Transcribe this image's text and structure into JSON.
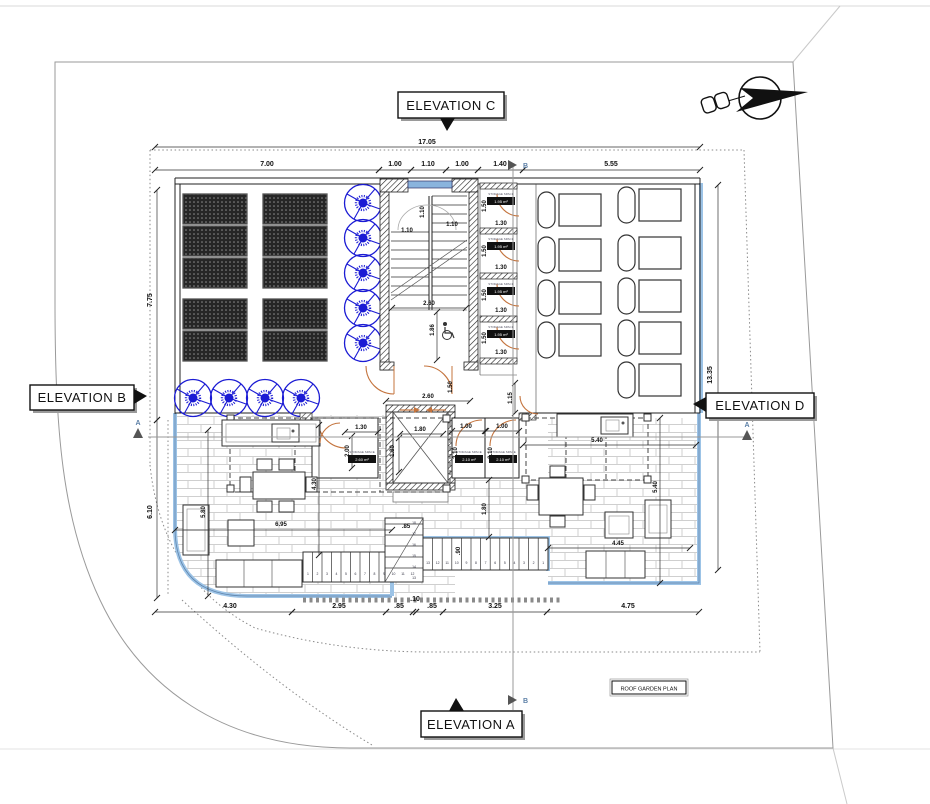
{
  "page": {
    "plan_title": "ROOF GARDEN PLAN"
  },
  "elevations": {
    "a": "ELEVATION A",
    "b": "ELEVATION B",
    "c": "ELEVATION C",
    "d": "ELEVATION D"
  },
  "sections": {
    "a": "A",
    "b": "B"
  },
  "storage": {
    "label": "STORAGE SPACE",
    "area_small": "1.95 m²",
    "area_mid_left": "2.60 m²",
    "area_mid_right": "2.10 m²"
  },
  "stairs": {
    "run_a": [
      "1",
      "2",
      "3",
      "4",
      "5",
      "6",
      "7",
      "8",
      "9",
      "10",
      "11",
      "12"
    ],
    "run_b": [
      "13",
      "12",
      "11",
      "10",
      "9",
      "8",
      "7",
      "6",
      "5",
      "4",
      "3",
      "2",
      "1"
    ],
    "run_c": [
      "18",
      "17",
      "16",
      "15",
      "14",
      "13"
    ]
  },
  "colors": {
    "deck_edge": "#9cc3e6",
    "tree": "#1b1bd4",
    "door": "#c4743e",
    "wall": "#222222",
    "brick_joint": "#cfcfcf",
    "section_line": "#999999",
    "boundary": "#9a9a9a"
  },
  "dims": [
    {
      "t": "17.05",
      "x": 427,
      "y": 144,
      "s": 7,
      "l": [
        155,
        147,
        700,
        147
      ]
    },
    {
      "t": "7.00",
      "x": 267,
      "y": 166,
      "s": 7,
      "l": [
        155,
        170,
        379,
        170
      ]
    },
    {
      "t": "1.00",
      "x": 395,
      "y": 166,
      "s": 7,
      "l": [
        379,
        170,
        411,
        170
      ]
    },
    {
      "t": "1.10",
      "x": 428,
      "y": 166,
      "s": 7,
      "l": [
        411,
        170,
        446,
        170
      ]
    },
    {
      "t": "1.00",
      "x": 462,
      "y": 166,
      "s": 7,
      "l": [
        446,
        170,
        478,
        170
      ]
    },
    {
      "t": "1.40",
      "x": 500,
      "y": 166,
      "s": 7,
      "l": [
        478,
        170,
        523,
        170
      ]
    },
    {
      "t": "5.55",
      "x": 611,
      "y": 166,
      "s": 7,
      "l": [
        523,
        170,
        700,
        170
      ]
    },
    {
      "t": "7.75",
      "x": 152,
      "y": 300,
      "r": -90,
      "s": 7,
      "l": [
        157,
        190,
        157,
        420
      ]
    },
    {
      "t": "6.10",
      "x": 152,
      "y": 512,
      "r": -90,
      "s": 7,
      "l": [
        157,
        420,
        157,
        598
      ]
    },
    {
      "t": "13.35",
      "x": 712,
      "y": 375,
      "r": -90,
      "s": 7,
      "l": [
        718,
        185,
        718,
        570
      ]
    },
    {
      "t": "4.30",
      "x": 230,
      "y": 608,
      "s": 7,
      "l": [
        155,
        612,
        292,
        612
      ]
    },
    {
      "t": "2.95",
      "x": 339,
      "y": 608,
      "s": 7,
      "l": [
        292,
        612,
        386,
        612
      ]
    },
    {
      "t": ".85",
      "x": 399,
      "y": 608,
      "s": 7,
      "l": [
        386,
        612,
        413,
        612
      ]
    },
    {
      "t": ".10",
      "x": 415,
      "y": 601,
      "s": 7,
      "l": [
        413,
        612,
        416,
        612
      ]
    },
    {
      "t": ".85",
      "x": 432,
      "y": 608,
      "s": 7,
      "l": [
        416,
        612,
        443,
        612
      ]
    },
    {
      "t": "3.25",
      "x": 495,
      "y": 608,
      "s": 7,
      "l": [
        443,
        612,
        547,
        612
      ]
    },
    {
      "t": "4.75",
      "x": 628,
      "y": 608,
      "s": 7,
      "l": [
        547,
        612,
        699,
        612
      ]
    },
    {
      "t": "1.10",
      "x": 424,
      "y": 212,
      "r": -90,
      "s": 6
    },
    {
      "t": "1.10",
      "x": 407,
      "y": 232,
      "s": 6
    },
    {
      "t": "1.10",
      "x": 452,
      "y": 226,
      "s": 6
    },
    {
      "t": "2.60",
      "x": 429,
      "y": 305,
      "s": 6,
      "l": [
        392,
        308,
        466,
        308
      ]
    },
    {
      "t": "1.86",
      "x": 434,
      "y": 330,
      "r": -90,
      "s": 6,
      "l": [
        437,
        312,
        437,
        360
      ]
    },
    {
      "t": "2.60",
      "x": 428,
      "y": 398,
      "s": 6,
      "l": [
        386,
        401,
        470,
        401
      ]
    },
    {
      "t": "1.50",
      "x": 452,
      "y": 387,
      "r": -90,
      "s": 6
    },
    {
      "t": "1.15",
      "x": 512,
      "y": 398,
      "r": -90,
      "s": 6,
      "l": [
        515,
        383,
        515,
        413
      ]
    },
    {
      "t": "1.50",
      "x": 486,
      "y": 206,
      "r": -90,
      "s": 6
    },
    {
      "t": "1.30",
      "x": 501,
      "y": 225,
      "s": 6
    },
    {
      "t": "1.50",
      "x": 486,
      "y": 251,
      "r": -90,
      "s": 6
    },
    {
      "t": "1.30",
      "x": 501,
      "y": 269,
      "s": 6
    },
    {
      "t": "1.50",
      "x": 486,
      "y": 295,
      "r": -90,
      "s": 6
    },
    {
      "t": "1.30",
      "x": 501,
      "y": 312,
      "s": 6
    },
    {
      "t": "1.50",
      "x": 486,
      "y": 338,
      "r": -90,
      "s": 6
    },
    {
      "t": "1.30",
      "x": 501,
      "y": 354,
      "s": 6
    },
    {
      "t": "1.30",
      "x": 361,
      "y": 429,
      "s": 6,
      "l": [
        345,
        432,
        378,
        432
      ]
    },
    {
      "t": "2.00",
      "x": 349,
      "y": 451,
      "r": -90,
      "s": 6,
      "l": [
        352,
        436,
        352,
        468
      ]
    },
    {
      "t": "1.80",
      "x": 420,
      "y": 431,
      "s": 6,
      "l": [
        400,
        434,
        443,
        434
      ]
    },
    {
      "t": "1.80",
      "x": 394,
      "y": 451,
      "r": -90,
      "s": 6,
      "l": [
        399,
        438,
        399,
        472
      ]
    },
    {
      "t": "1.00",
      "x": 466,
      "y": 428,
      "s": 6,
      "l": [
        452,
        431,
        485,
        431
      ]
    },
    {
      "t": "1.00",
      "x": 502,
      "y": 428,
      "s": 6,
      "l": [
        486,
        431,
        519,
        431
      ]
    },
    {
      "t": "2.10",
      "x": 457,
      "y": 453,
      "r": -90,
      "s": 6
    },
    {
      "t": "2.10",
      "x": 492,
      "y": 453,
      "r": -90,
      "s": 6
    },
    {
      "t": "4.30",
      "x": 316,
      "y": 484,
      "r": -90,
      "s": 6,
      "l": [
        319,
        425,
        319,
        555
      ]
    },
    {
      "t": "6.95",
      "x": 281,
      "y": 526,
      "s": 6,
      "l": [
        175,
        530,
        392,
        530
      ]
    },
    {
      "t": "5.80",
      "x": 205,
      "y": 512,
      "r": -90,
      "s": 6,
      "l": [
        208,
        430,
        208,
        596
      ]
    },
    {
      "t": ".85",
      "x": 406,
      "y": 528,
      "s": 6
    },
    {
      "t": ".90",
      "x": 460,
      "y": 551,
      "r": -90,
      "s": 6
    },
    {
      "t": "1.80",
      "x": 486,
      "y": 509,
      "r": -90,
      "s": 6,
      "l": [
        489,
        480,
        489,
        537
      ]
    },
    {
      "t": "5.40",
      "x": 597,
      "y": 442,
      "s": 6,
      "l": [
        523,
        445,
        696,
        445
      ]
    },
    {
      "t": "5.40",
      "x": 657,
      "y": 487,
      "r": -90,
      "s": 6,
      "l": [
        660,
        418,
        660,
        583
      ]
    },
    {
      "t": "4.45",
      "x": 618,
      "y": 545,
      "s": 6,
      "l": [
        548,
        548,
        690,
        548
      ]
    }
  ]
}
